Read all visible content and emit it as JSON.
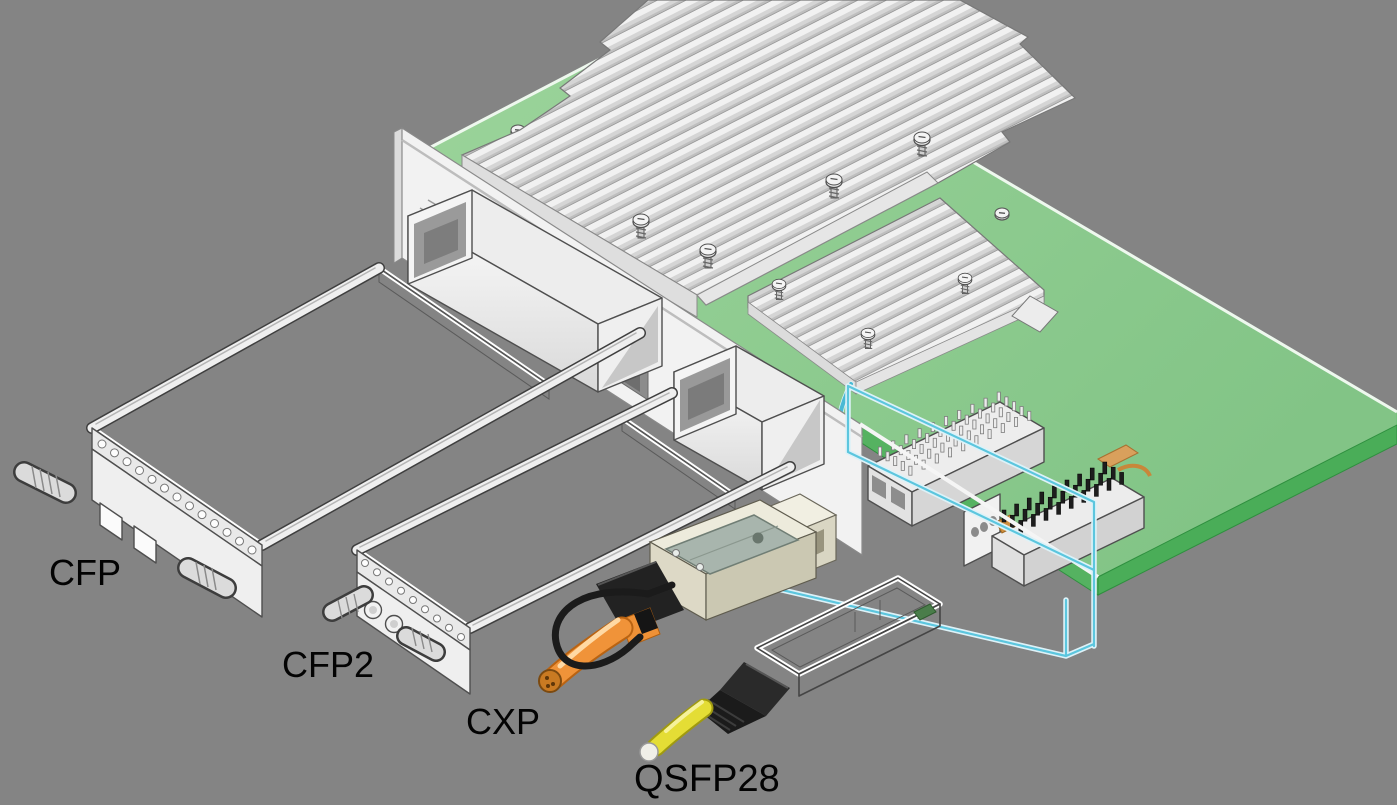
{
  "scene": {
    "background_color": "#848484",
    "description": "Isometric technical illustration of pluggable optical transceiver form factors in front of a green line card with heatsinks, cages and board connectors"
  },
  "labels": {
    "cfp": "CFP",
    "cfp2": "CFP2",
    "cxp": "CXP",
    "qsfp28": "QSFP28"
  },
  "palette": {
    "background": "#848484",
    "pcb_green": "#8fcb8f",
    "pcb_edge_green": "#4aad58",
    "heatsink_gray": "#e9e9e9",
    "line_art": "#4a4a4a",
    "cxp_cable_orange": "#f09339",
    "qsfp_cable_yellow": "#e4dd35",
    "guide_wireframe_cyan": "#5cc6de",
    "cxp_body_ivory": "#edebdc",
    "cxp_clip_gray": "#a8b5ad",
    "label_color": "#030303"
  },
  "components": {
    "line_card": "green PCB line card",
    "heatsink_large": "large finned heatsink",
    "heatsink_small": "small finned heatsink",
    "front_panel": "front panel bracket with cage opening",
    "cage_a": "transceiver cage (large)",
    "cage_b": "transceiver cage (small)",
    "pin_grid_connector": "pin-grid board connector",
    "header_connector": "black-pin header connector",
    "guide_wireframe": "cyan module guide outline",
    "cfp_module": "CFP transceiver module",
    "cfp2_module": "CFP2 transceiver module",
    "cxp_module": "CXP cabled transceiver plug",
    "qsfp28_module": "QSFP28 transceiver with fiber pigtail"
  }
}
